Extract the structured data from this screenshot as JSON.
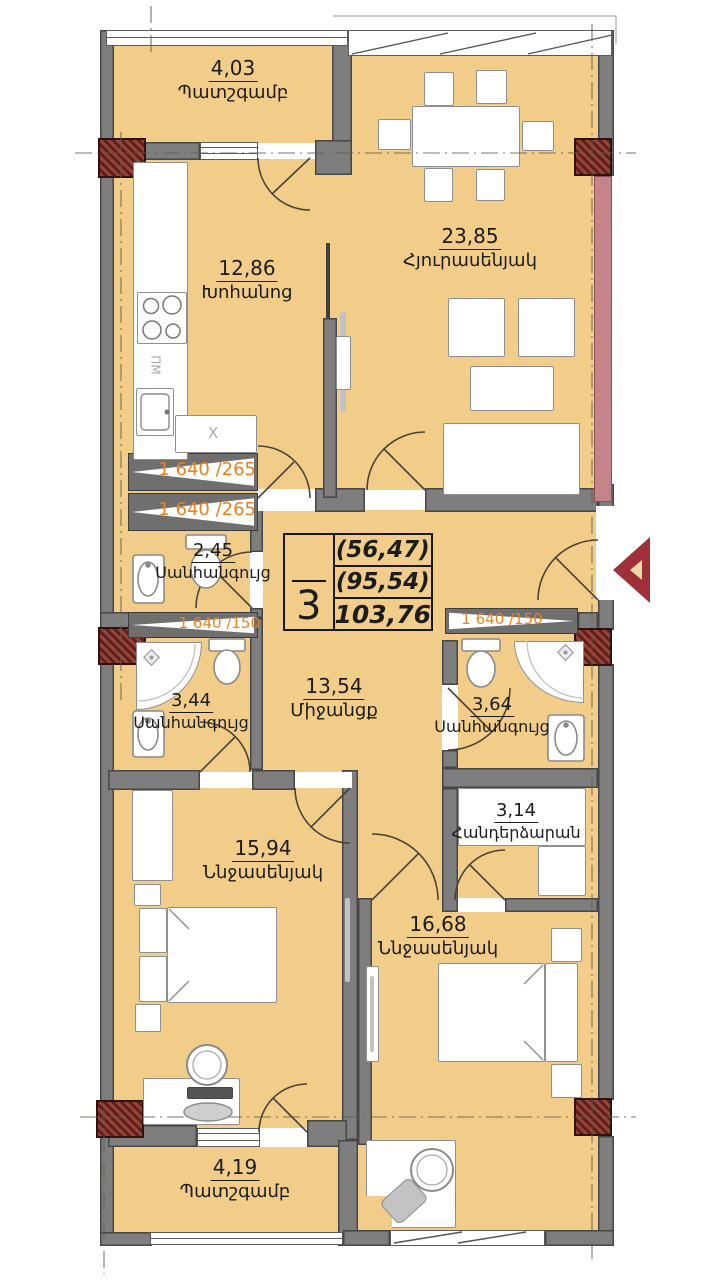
{
  "plan": {
    "type": "apartment-floor-plan",
    "colors": {
      "room_fill": "#f2cd8a",
      "wall": "#7e7e7e",
      "column_hatch": "#7c2b24",
      "facade_strip": "#c5848a",
      "accent_text": "#e8821e",
      "entrance_arrow": "#9e3039"
    }
  },
  "rooms": {
    "balcony_top": {
      "area": "4,03",
      "name": "Պատշգամբ"
    },
    "living": {
      "area": "23,85",
      "name": "Հյուրասենյակ"
    },
    "kitchen": {
      "area": "12,86",
      "name": "Խոհանոց"
    },
    "wc_small": {
      "area": "2,45",
      "name": "Սանհանգույց"
    },
    "wc_left": {
      "area": "3,44",
      "name": "Սանհանգույց"
    },
    "corridor": {
      "area": "13,54",
      "name": "Միջանցք"
    },
    "wc_right": {
      "area": "3,64",
      "name": "Սանհանգույց"
    },
    "dressing": {
      "area": "3,14",
      "name": "Հանդերձարան"
    },
    "bedroom_left": {
      "area": "15,94",
      "name": "Ննջասենյակ"
    },
    "bedroom_right": {
      "area": "16,68",
      "name": "Ննջասենյակ"
    },
    "balcony_bottom": {
      "area": "4,19",
      "name": "Պատշգամբ"
    }
  },
  "info_box": {
    "rooms_count": "3",
    "value_1": "(56,47)",
    "value_2": "(95,54)",
    "value_3": "103,76"
  },
  "beam_labels": {
    "left_1": "1 640 /265",
    "left_2": "1 640 /265",
    "mid_left": "1 640 /150",
    "mid_right": "1 640 /150"
  },
  "kitchen_labels": {
    "dishwasher": "ПМ",
    "hood": "X"
  }
}
